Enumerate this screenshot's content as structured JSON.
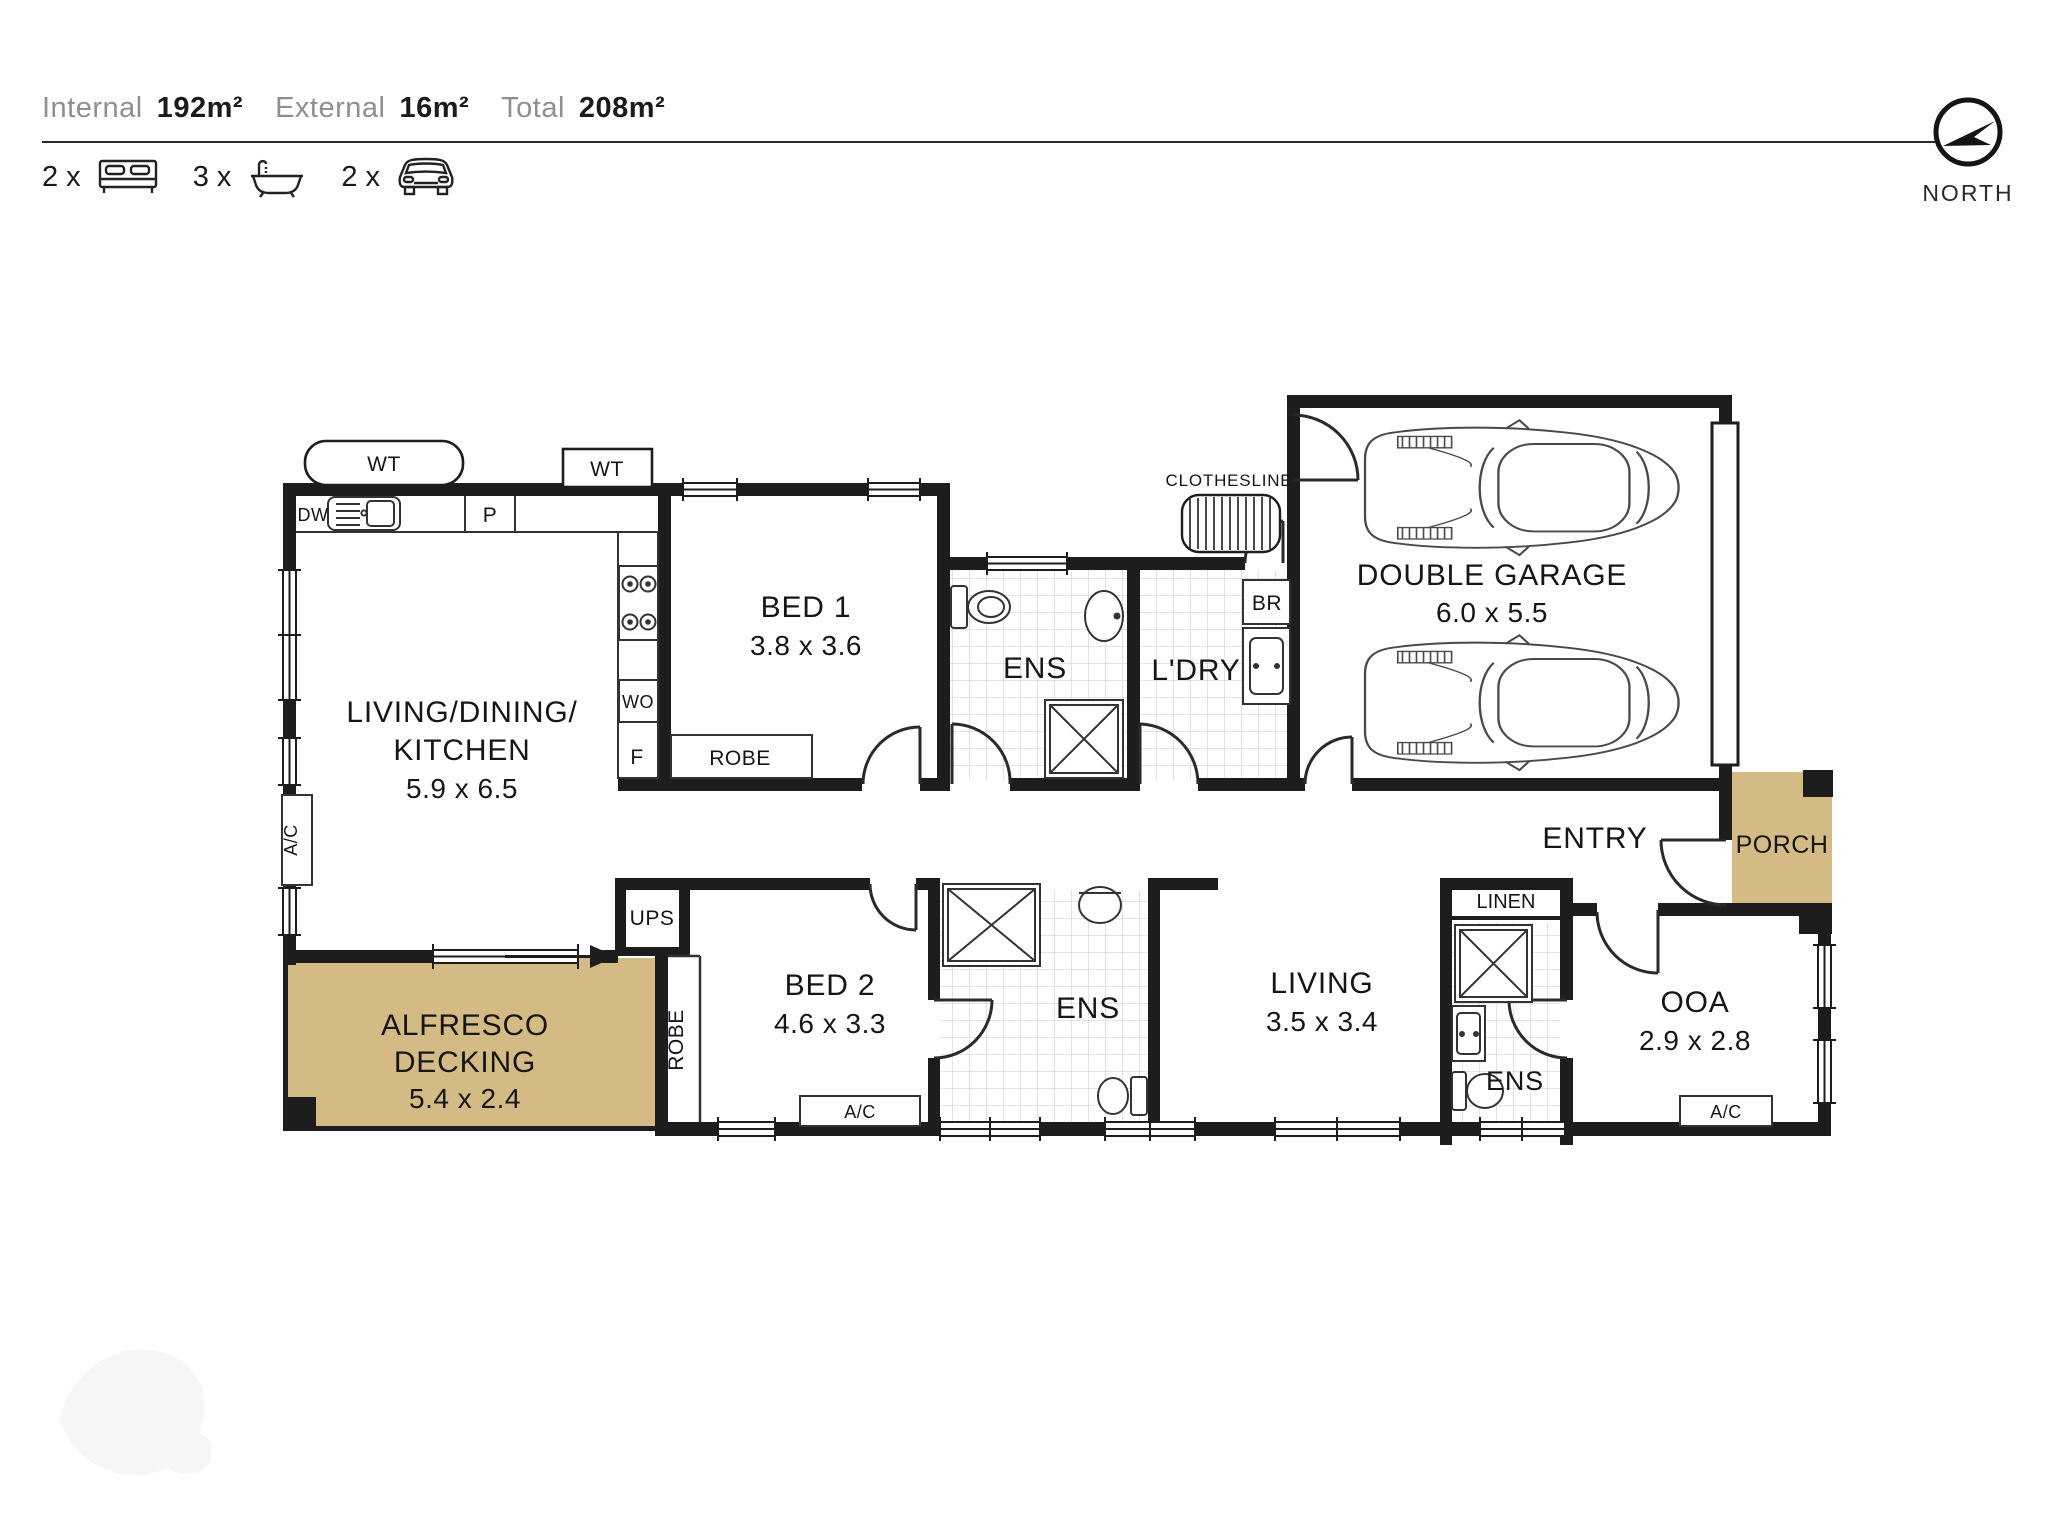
{
  "header": {
    "internal_label": "Internal",
    "internal_value": "192m²",
    "external_label": "External",
    "external_value": "16m²",
    "total_label": "Total",
    "total_value": "208m²",
    "bed_count": "2 x",
    "bath_count": "3 x",
    "car_count": "2 x"
  },
  "compass": {
    "label": "NORTH"
  },
  "colors": {
    "wall": "#1d1d1d",
    "deck": "#d4ba84",
    "tile_line": "#c9c9c9",
    "text": "#161616"
  },
  "rooms": {
    "ldk": {
      "line1": "LIVING/DINING/",
      "line2": "KITCHEN",
      "dims": "5.9 x 6.5"
    },
    "bed1": {
      "name": "BED 1",
      "dims": "3.8 x 3.6"
    },
    "ens1": {
      "name": "ENS"
    },
    "laundry": {
      "name": "L'DRY"
    },
    "garage": {
      "name": "DOUBLE GARAGE",
      "dims": "6.0 x 5.5"
    },
    "entry": {
      "name": "ENTRY"
    },
    "porch": {
      "name": "PORCH"
    },
    "ooa": {
      "name": "OOA",
      "dims": "2.9 x 2.8"
    },
    "living": {
      "name": "LIVING",
      "dims": "3.5 x 3.4"
    },
    "linen": {
      "name": "LINEN"
    },
    "ens3": {
      "name": "ENS"
    },
    "bed2": {
      "name": "BED 2",
      "dims": "4.6 x 3.3"
    },
    "ens2": {
      "name": "ENS"
    },
    "alfresco": {
      "line1": "ALFRESCO",
      "line2": "DECKING",
      "dims": "5.4 x 2.4"
    },
    "ups": {
      "name": "UPS"
    }
  },
  "fixtures": {
    "wt1": "WT",
    "wt2": "WT",
    "dw": "DW",
    "pantry": "P",
    "wall_oven": "WO",
    "fridge": "F",
    "robe1": "ROBE",
    "robe2": "ROBE",
    "broom": "BR",
    "clothesline": "CLOTHESLINE",
    "ac_living": "A/C",
    "ac_bed2": "A/C",
    "ac_ooa": "A/C"
  }
}
